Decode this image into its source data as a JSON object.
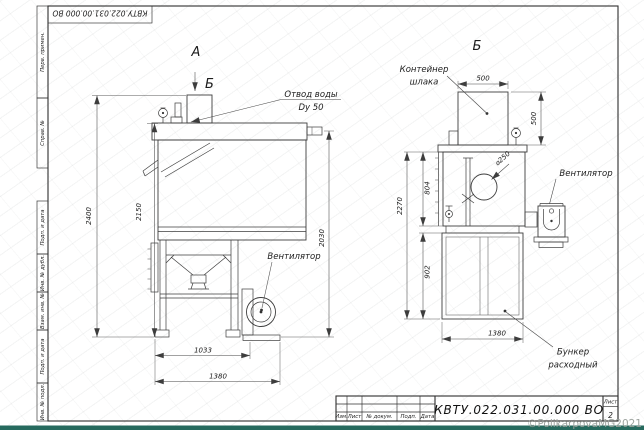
{
  "page": {
    "watermark": "©PolikarpovaMG2021"
  },
  "frame": {
    "doc_number": "КВТУ.022.031.00.000 ВО",
    "side_labels": [
      "Перв. примен.",
      "Справ. №",
      "Подп. и дата",
      "Инв. № дубл.",
      "Взам. инв. №",
      "Подп. и дата",
      "Инв. № подл."
    ]
  },
  "title_block": {
    "doc_number": "КВТУ.022.031.00.000 ВО",
    "columns": [
      "Изм.",
      "Лист",
      "№ докум.",
      "Подп.",
      "Дата"
    ],
    "sheet_label": "Лист",
    "sheet_number": "2"
  },
  "front_view": {
    "view_label": "А",
    "section_arrow_label": "Б",
    "callout_water_outlet_line1": "Отвод воды",
    "callout_water_outlet_line2": "Dy 50",
    "callout_fan": "Вентилятор",
    "dim_height_total": "2400",
    "dim_height_body": "2150",
    "dim_height_outlet": "2030",
    "dim_width_frame": "1033",
    "dim_width_total": "1380"
  },
  "side_view": {
    "view_label": "Б",
    "callout_container_line1": "Контейнер",
    "callout_container_line2": "шлака",
    "callout_fan": "Вентилятор",
    "callout_hopper_line1": "Бункер",
    "callout_hopper_line2": "расходный",
    "callout_hole_dia": "⌀250",
    "dim_container_width": "500",
    "dim_container_height": "500",
    "dim_height_total": "2270",
    "dim_height_upper": "804",
    "dim_height_lower": "902",
    "dim_width_total": "1380"
  }
}
